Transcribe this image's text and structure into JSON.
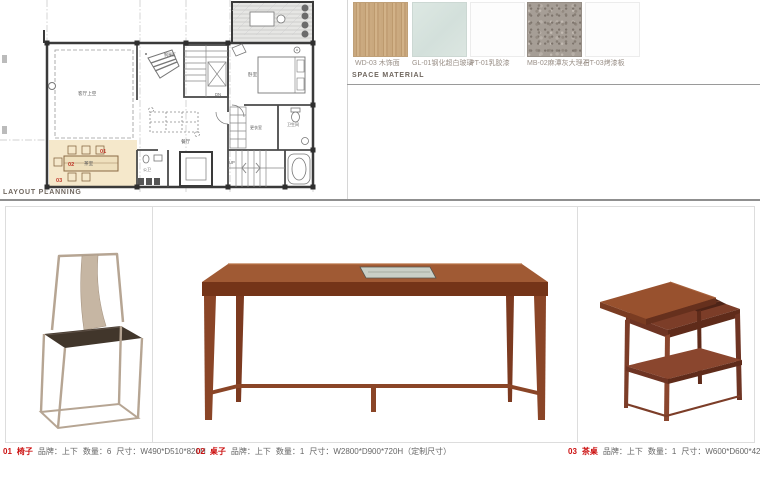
{
  "page": {
    "layout_planning_label": "LAYOUT PLANNING",
    "space_material_label": "SPACE MATERIAL"
  },
  "colors": {
    "accent_red": "#cc1111",
    "tea_room_highlight": "#f5e8cb",
    "wood_swatch": "#c9a87e",
    "glass_swatch": "#d8e3df",
    "marble_swatch": "#a69e96",
    "table_wood": "#8a4527"
  },
  "floor_plan": {
    "rooms": [
      {
        "name": "客厅上空"
      },
      {
        "name": "钢琴区"
      },
      {
        "name": "卧室"
      },
      {
        "name": "更衣室"
      },
      {
        "name": "卫生间"
      },
      {
        "name": "餐厅"
      },
      {
        "name": "公卫"
      },
      {
        "name": "茶室"
      }
    ],
    "stairs": {
      "down": "DN",
      "up": "UP"
    },
    "markers": [
      {
        "id": "01"
      },
      {
        "id": "02"
      },
      {
        "id": "03"
      }
    ]
  },
  "materials": {
    "swatches": [
      {
        "code": "WD-03",
        "name": "木饰面",
        "label": "WD-03 木饰面"
      },
      {
        "code": "GL-01",
        "name": "钢化超白玻璃",
        "label": "GL-01钢化超白玻璃"
      },
      {
        "code": "PT-01",
        "name": "乳胶漆",
        "label": "PT-01乳胶漆"
      },
      {
        "code": "MB-02",
        "name": "麻潭灰大理石",
        "label": "MB-02麻潭灰大理石"
      },
      {
        "code": "PT-03",
        "name": "烤漆板",
        "label": "PT-03烤漆板"
      }
    ]
  },
  "furniture": [
    {
      "no": "01",
      "name": "椅子",
      "brand": "品牌：上下",
      "qty": "数量：6",
      "size": "尺寸：W490*D510*820H"
    },
    {
      "no": "02",
      "name": "桌子",
      "brand": "品牌：上下",
      "qty": "数量：1",
      "size": "尺寸：W2800*D900*720H（定制尺寸）"
    },
    {
      "no": "03",
      "name": "茶桌",
      "brand": "品牌：上下",
      "qty": "数量：1",
      "size": "尺寸：W600*D600*420H（定制尺寸）"
    }
  ]
}
